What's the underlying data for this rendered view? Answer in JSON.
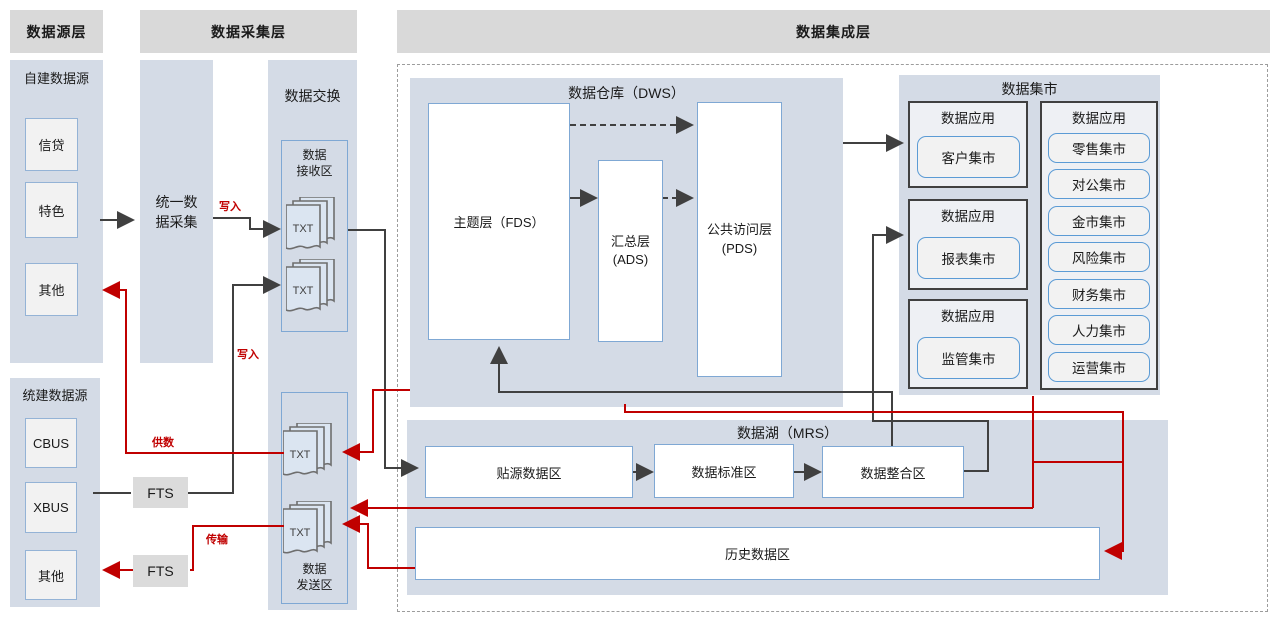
{
  "headers": {
    "source_layer": "数据源层",
    "collect_layer": "数据采集层",
    "integration_layer": "数据集成层"
  },
  "source_layer": {
    "self_built": {
      "title": "自建数据源",
      "items": [
        "信贷",
        "特色",
        "其他"
      ]
    },
    "unified": {
      "title": "统建数据源",
      "items": [
        "CBUS",
        "XBUS",
        "其他"
      ]
    }
  },
  "collect_layer": {
    "unified_collect": "统一数\n据采集",
    "fts_top": "FTS",
    "fts_bottom": "FTS"
  },
  "exchange": {
    "title": "数据交换",
    "receive": {
      "title": "数据\n接收区",
      "files": [
        "TXT",
        "TXT"
      ]
    },
    "send": {
      "title": "数据\n发送区",
      "files": [
        "TXT",
        "TXT"
      ]
    }
  },
  "dws": {
    "title": "数据仓库（DWS）",
    "fds": "主题层（FDS）",
    "ads": "汇总层\n(ADS)",
    "pds": "公共访问层\n(PDS)"
  },
  "mart": {
    "title": "数据集市",
    "apps": [
      {
        "title": "数据应用",
        "item": "客户集市"
      },
      {
        "title": "数据应用",
        "item": "报表集市"
      },
      {
        "title": "数据应用",
        "item": "监管集市"
      }
    ],
    "right_app": {
      "title": "数据应用",
      "items": [
        "零售集市",
        "对公集市",
        "金市集市",
        "风险集市",
        "财务集市",
        "人力集市",
        "运营集市"
      ]
    }
  },
  "lake": {
    "title": "数据湖（MRS）",
    "zones": [
      "贴源数据区",
      "数据标准区",
      "数据整合区"
    ],
    "history": "历史数据区"
  },
  "edge_labels": {
    "write1": "写入",
    "write2": "写入",
    "supply": "供数",
    "transfer": "传输"
  },
  "colors": {
    "header_gray": "#D9D9D9",
    "container_blue": "#D4DBE6",
    "accent_blue": "#5B9BD5",
    "line_black": "#404040",
    "line_red": "#C00000"
  }
}
